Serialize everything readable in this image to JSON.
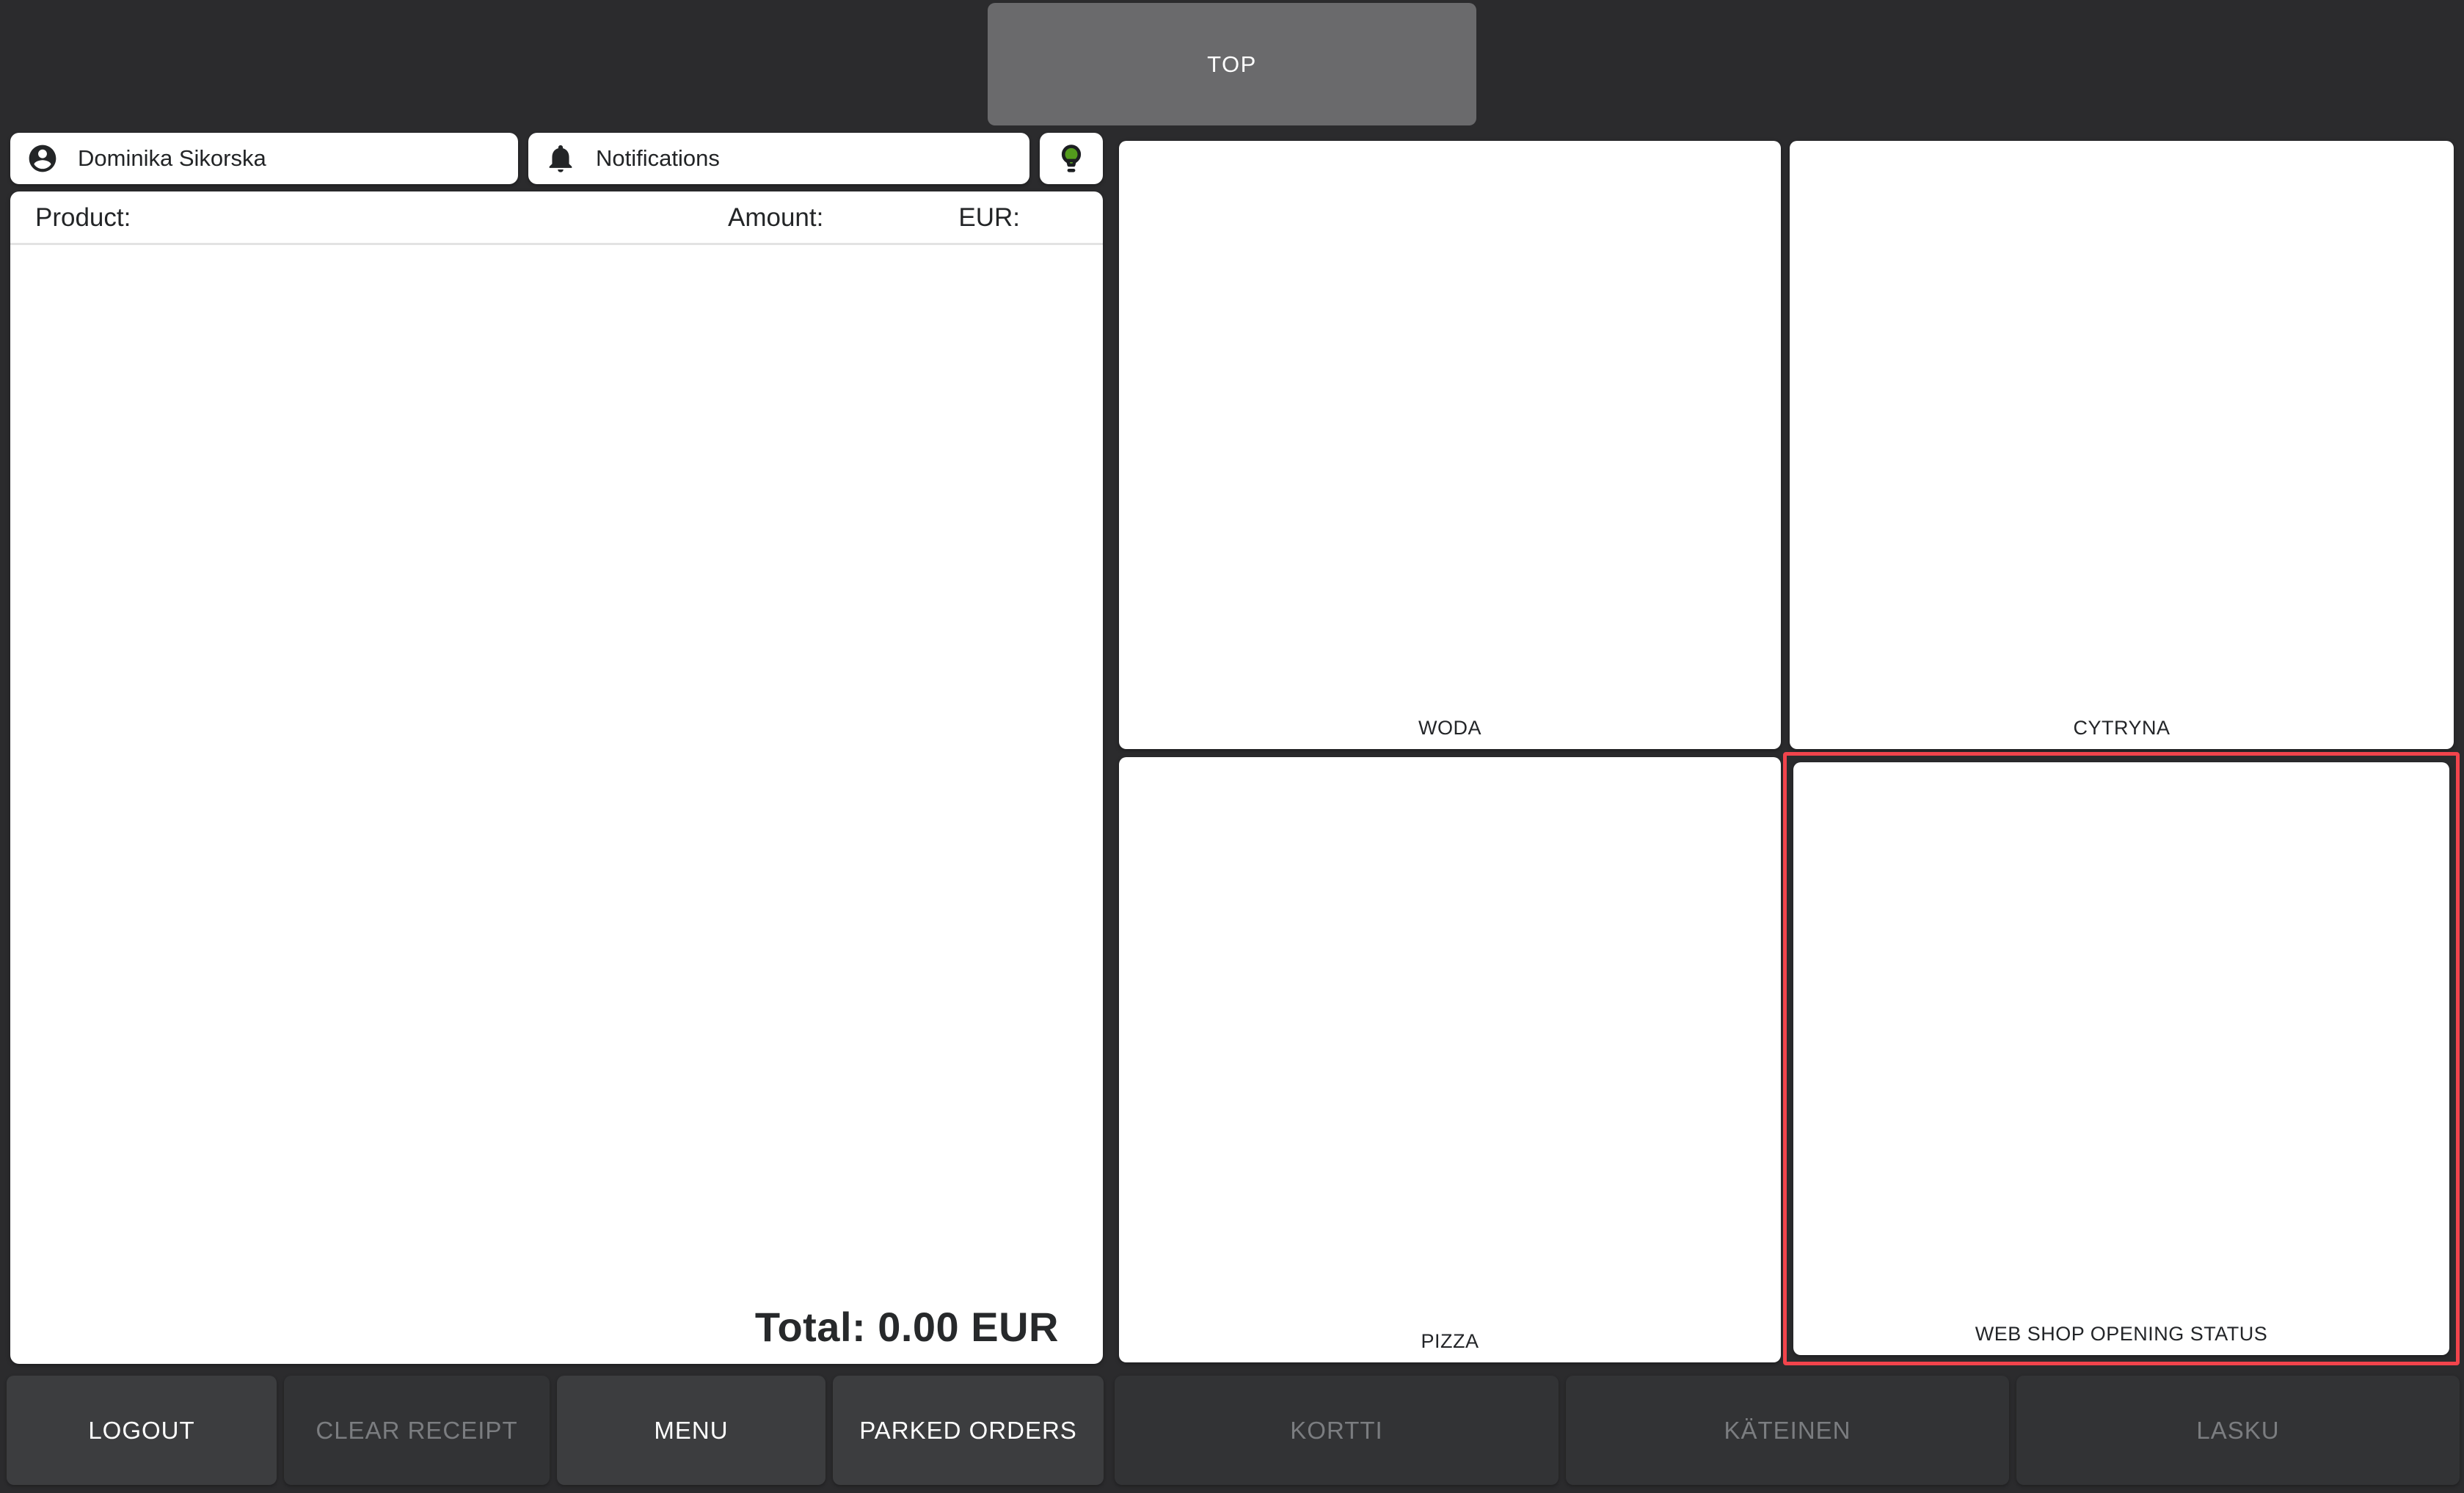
{
  "top_nav": {
    "top_button_label": "TOP"
  },
  "user_bar": {
    "user_name": "Dominika Sikorska",
    "notifications_label": "Notifications"
  },
  "receipt": {
    "columns": {
      "product": "Product:",
      "amount": "Amount:",
      "eur": "EUR:"
    },
    "items": [],
    "total_label": "Total: 0.00 EUR",
    "total_value": "0.00",
    "currency": "EUR"
  },
  "product_tiles": [
    {
      "label": "WODA",
      "highlighted": false
    },
    {
      "label": "CYTRYNA",
      "highlighted": false
    },
    {
      "label": "PIZZA",
      "highlighted": false
    },
    {
      "label": "WEB SHOP OPENING STATUS",
      "highlighted": true
    }
  ],
  "action_bar": [
    {
      "label": "LOGOUT",
      "enabled": true
    },
    {
      "label": "CLEAR RECEIPT",
      "enabled": false
    },
    {
      "label": "MENU",
      "enabled": true
    },
    {
      "label": "PARKED ORDERS",
      "enabled": true
    },
    {
      "label": "KORTTI",
      "enabled": false
    },
    {
      "label": "KÄTEINEN",
      "enabled": false
    },
    {
      "label": "LASKU",
      "enabled": false
    }
  ],
  "icons": {
    "user": "account-circle-icon",
    "notifications": "bell-icon",
    "tips": "lightbulb-icon"
  },
  "colors": {
    "background": "#2b2b2d",
    "panel": "#ffffff",
    "top_button": "#6a6a6c",
    "highlight_border": "#f2444c",
    "bulb_green": "#539b1d",
    "enabled_button": "#3c3d3f",
    "disabled_button": "#323335",
    "disabled_text": "#7b7d80",
    "text_dark": "#232527"
  }
}
